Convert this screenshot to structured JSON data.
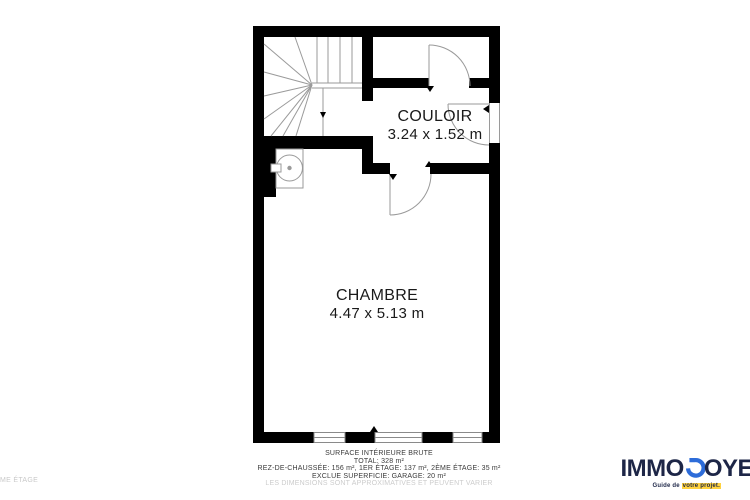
{
  "plan": {
    "floor_label": "ME ÉTAGE",
    "rooms": [
      {
        "name": "COULOIR",
        "dims": "3.24 x 1.52 m"
      },
      {
        "name": "CHAMBRE",
        "dims": "4.47 x 5.13 m"
      }
    ],
    "fixtures": [
      "staircase",
      "winder-steps",
      "door-top-right-room",
      "door-chambre",
      "door-right-wall",
      "washbasin",
      "window-left",
      "window-middle",
      "window-right"
    ],
    "colors": {
      "wall": "#000000",
      "line": "#9a9a9a",
      "text": "#1a1a1a",
      "muted": "#cccccc"
    }
  },
  "summary": {
    "lines": [
      "SURFACE INTÉRIEURE BRUTE",
      "TOTAL: 328 m²",
      "REZ-DE-CHAUSSÉE: 156 m², 1ER ÉTAGE: 137 m², 2ÈME ÉTAGE: 35 m²",
      "EXCLUE SUPERFICIE: GARAGE: 20 m²",
      "LES DIMENSIONS SONT APPROXIMATIVES ET PEUVENT VARIER"
    ]
  },
  "logo": {
    "part1": "IMMO",
    "part2": "OYE",
    "tagline_prefix": "Guide de ",
    "tagline_highlight": "votre projet.",
    "colors": {
      "navy": "#1d2647",
      "blue": "#2d6cd9",
      "highlight": "#ffd23f"
    }
  }
}
